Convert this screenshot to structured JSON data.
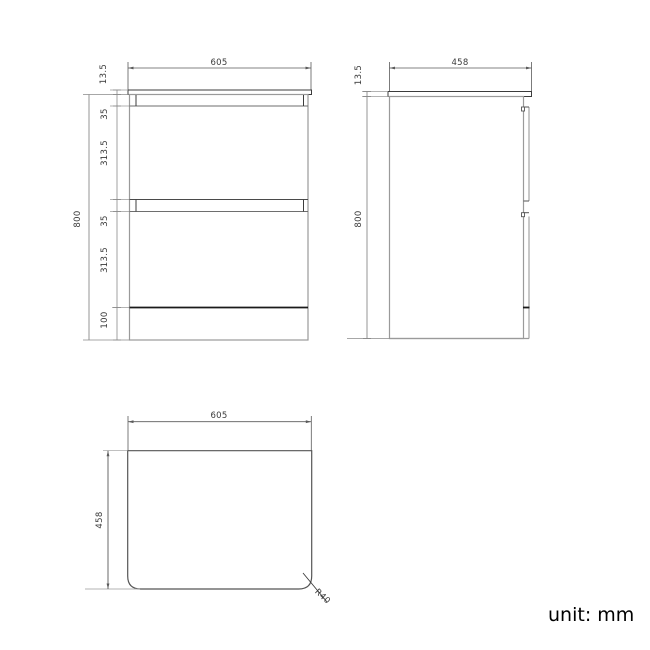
{
  "front_view": {
    "width_label": "605",
    "top_thickness_label": "13.5",
    "top_gap_label": "35",
    "drawer1_label": "313.5",
    "mid_gap_label": "35",
    "drawer2_label": "313.5",
    "plinth_label": "100",
    "height_label": "800"
  },
  "side_view": {
    "depth_label": "458",
    "top_thickness_label": "13.5",
    "height_label": "800"
  },
  "plan_view": {
    "width_label": "605",
    "depth_label": "458",
    "radius_label": "R40"
  },
  "footer": {
    "unit_label": "unit: mm"
  }
}
